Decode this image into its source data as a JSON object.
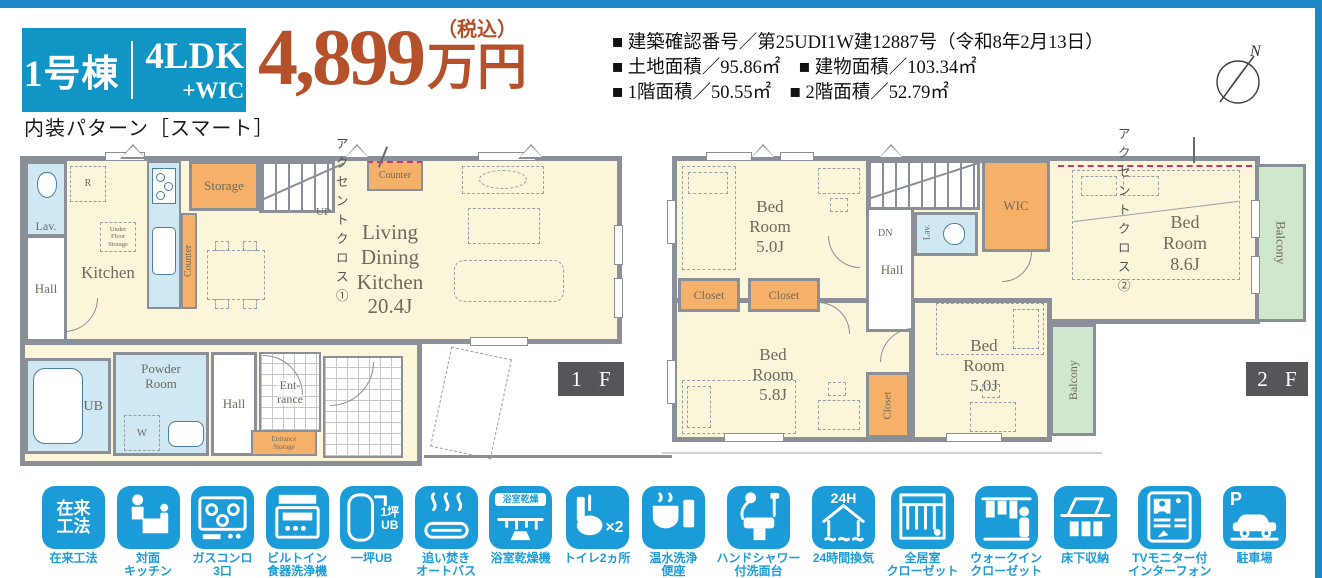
{
  "palette": {
    "teal": "#1095c5",
    "bar_blue": "#1d86c8",
    "price_red": "#b5512a",
    "icon_blue": "#1b9cd8",
    "wall_gray": "#8b8f98",
    "cream": "#fbf6da",
    "room_blue": "#cfe8f4",
    "room_orange": "#f5b06a",
    "balcony_green": "#cfe8cd",
    "floor_badge": "#55565a",
    "accent_pink": "#d6336b"
  },
  "header": {
    "badge": {
      "unit_no": "1号棟",
      "layout": "4LDK",
      "layout_extra": "+WIC"
    },
    "interior_pattern": "内装パターン［スマート］",
    "price": {
      "amount": "4,899",
      "tax_note": "（税込）",
      "unit": "万円"
    },
    "details": [
      "■ 建築確認番号／第25UDI1W建12887号（令和8年2月13日）",
      "■ 土地面積／95.86㎡　■ 建物面積／103.34㎡",
      "■ 1階面積／50.55㎡　■ 2階面積／52.79㎡"
    ],
    "compass_n": "N"
  },
  "floor1": {
    "badge": "1 F",
    "accent_label": "アクセントクロス①",
    "labels": {
      "lav": "Lav.",
      "hall_upper": "Hall",
      "kitchen": "Kitchen",
      "r_mark": "R",
      "under_floor": "Under\nFloor\nStorage",
      "storage": "Storage",
      "up": "UP",
      "counter_side": "Counter",
      "counter_accent": "Counter",
      "ldk": "Living\nDining\nKitchen\n20.4J",
      "ub": "UB",
      "powder": "Powder\nRoom",
      "w_mark": "W",
      "hall_lower": "Hall",
      "entrance": "Ent-\nrance",
      "entrance_storage": "Entrance\nStorage"
    }
  },
  "floor2": {
    "badge": "2 F",
    "accent_label": "アクセントクロス②",
    "labels": {
      "bed1": "Bed\nRoom\n5.0J",
      "closet1": "Closet",
      "closet2": "Closet",
      "dn": "DN",
      "hall": "Hall",
      "lav": "Lav.",
      "wic": "WIC",
      "bed2": "Bed\nRoom\n8.6J",
      "balcony_right": "Balcony",
      "bed3": "Bed\nRoom\n5.8J",
      "closet3": "Closet",
      "bed4": "Bed\nRoom\n5.0J",
      "balcony_bottom": "Balcony"
    }
  },
  "features": [
    {
      "label": "在来工法",
      "badge": "在来\n工法"
    },
    {
      "label": "対面\nキッチン"
    },
    {
      "label": "ガスコンロ\n3口"
    },
    {
      "label": "ビルトイン\n食器洗浄機"
    },
    {
      "label": "一坪UB",
      "badge": "1坪\nUB"
    },
    {
      "label": "追い焚き\nオートバス"
    },
    {
      "label": "浴室乾燥機",
      "badge": "浴室乾燥"
    },
    {
      "label": "トイレ2ヵ所",
      "badge": "×2"
    },
    {
      "label": "温水洗浄\n便座"
    },
    {
      "label": "ハンドシャワー\n付洗面台"
    },
    {
      "label": "24時間換気",
      "badge": "24H"
    },
    {
      "label": "全居室\nクローゼット"
    },
    {
      "label": "ウォークイン\nクローゼット"
    },
    {
      "label": "床下収納"
    },
    {
      "label": "TVモニター付\nインターフォン"
    },
    {
      "label": "駐車場",
      "badge": "P"
    }
  ]
}
